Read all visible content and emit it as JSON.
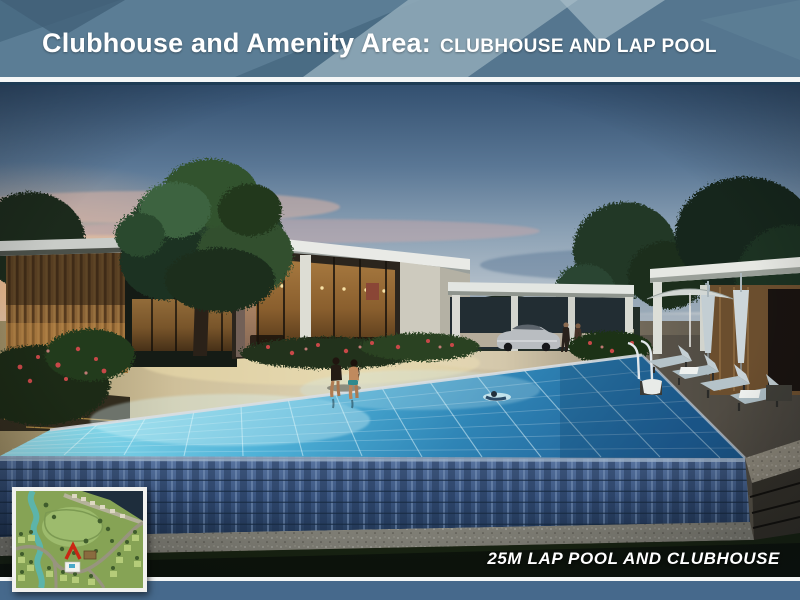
{
  "header": {
    "title_main": "Clubhouse and Amenity Area:",
    "title_sub": "CLUBHOUSE AND LAP POOL",
    "bg_color": "#4a6c84",
    "text_color": "#ffffff"
  },
  "photo": {
    "caption": "25M LAP POOL AND CLUBHOUSE"
  },
  "inset_map": {
    "marker_color": "#c92714"
  },
  "footer": {
    "bar_color": "#46698c",
    "separator_color": "#f4f6f6"
  }
}
